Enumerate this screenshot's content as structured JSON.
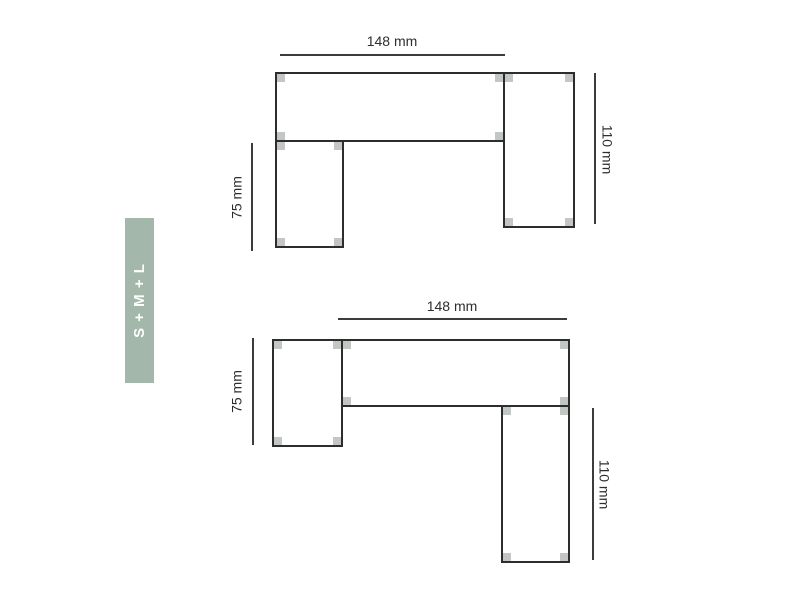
{
  "badge": {
    "label": "S + M + L"
  },
  "diagrams": [
    {
      "position": "top",
      "width_label": "148 mm",
      "right_label": "110 mm",
      "left_label": "75 mm"
    },
    {
      "position": "bottom",
      "width_label": "148 mm",
      "right_label": "110 mm",
      "left_label": "75 mm"
    }
  ],
  "colors": {
    "badge_bg": "#a4b7ab",
    "badge_text": "#ffffff",
    "outline": "#2d2d2d",
    "dim_line": "#3c3c3c",
    "label_text": "#2e2e2e",
    "corner_marker": "#c3c7c4",
    "background": "#ffffff"
  }
}
